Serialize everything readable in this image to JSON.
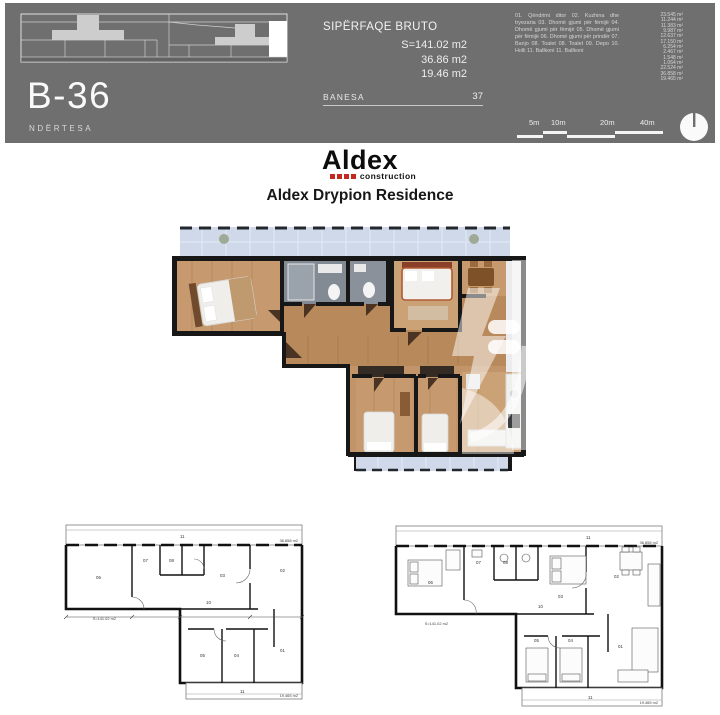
{
  "header": {
    "unit_code": "B-36",
    "building_label": "NDËRTESA",
    "area_title": "SIPËRFAQE BRUTO",
    "area_lines": [
      "S=141.02 m2",
      "36.86 m2",
      "19.46 m2"
    ],
    "banesa_label": "BANESA",
    "banesa_number": "37",
    "legend_text": "01. Qëndrimi ditor 02. Kuzhina dhe tryezaria 03. Dhomë gjumi për fëmijë 04. Dhomë gjumi për fëmijë 05. Dhomë gjumi për fëmijë 06. Dhomë gjumi për prindër 07. Banjo 08. Toalet 08. Toalet 09. Depo 10. Holli 11. Ballkoni 11. Ballkoni",
    "legend_areas": [
      "23.545 m²",
      "11.244 m²",
      "11.383 m²",
      "9.987 m²",
      "12.637 m²",
      "17.150 m²",
      "6.254 m²",
      "2.467 m²",
      "1.548 m²",
      "1.064 m²",
      "22.524 m²",
      "36.858 m²",
      "19.465 m²"
    ],
    "scale_labels": [
      "5m",
      "10m",
      "20m",
      "40m"
    ]
  },
  "brand": {
    "logo_text": "Aldex",
    "logo_sub": "construction",
    "residence_title": "Aldex Drypion Residence"
  },
  "floor_plans": {
    "left": {
      "area_note": "S=141.02 m2",
      "balcony_number_top": "11",
      "balcony_number_bottom": "11",
      "balcony_area_top": "36.858 m2",
      "balcony_area_bottom": "19.465 m2",
      "rooms": [
        "06",
        "07",
        "08",
        "03",
        "02",
        "10",
        "05",
        "04",
        "01"
      ]
    },
    "right": {
      "area_note": "S=141.02 m2",
      "balcony_number_top": "11",
      "balcony_number_bottom": "11",
      "balcony_area_top": "36.858 m2",
      "balcony_area_bottom": "19.465 m2",
      "rooms": [
        "06",
        "07",
        "08",
        "03",
        "02",
        "10",
        "05",
        "04",
        "01"
      ]
    }
  },
  "colors": {
    "header_bg": "#6f6f6f",
    "accent_red": "#c4281e",
    "balcony_blue": "#cfd9ea",
    "wood": "#c1946a"
  }
}
